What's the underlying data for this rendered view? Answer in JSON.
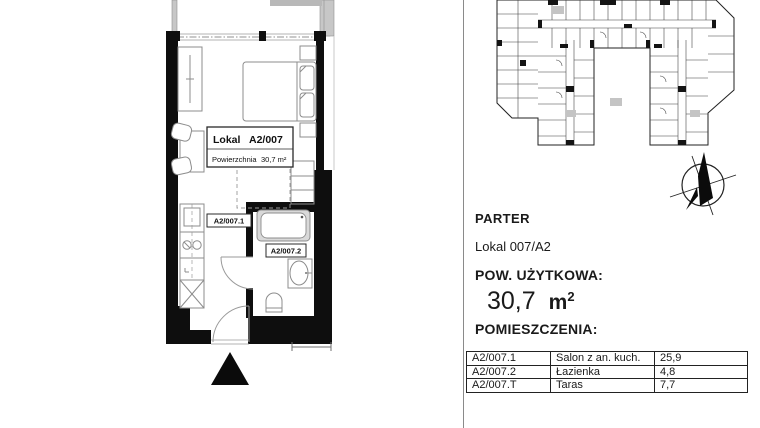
{
  "plan": {
    "label_box": {
      "title_left": "Lokal",
      "title_right": "A2/007",
      "area_label": "Powierzchnia",
      "area_value": "30,7 m²"
    },
    "room_tags": {
      "living": "A2/007.1",
      "bathroom": "A2/007.2"
    },
    "icons": {
      "compass": "compass-rose-north-arrow",
      "entrance": "entrance-triangle-marker"
    },
    "colors": {
      "wall": "#0e0e0e",
      "terrace_wall": "#c7c7c7",
      "furniture_line": "#8c8c8c"
    }
  },
  "info_panel": {
    "floor_label": "PARTER",
    "unit_label": "Lokal 007/A2",
    "area_heading": "POW. UŻYTKOWA:",
    "area_value": "30,7",
    "area_unit_base": "m",
    "area_unit_sup": "2",
    "rooms_heading": "POMIESZCZENIA:",
    "rooms_table": {
      "rows": [
        {
          "id": "A2/007.1",
          "name": "Salon z an. kuch.",
          "area": "25,9"
        },
        {
          "id": "A2/007.2",
          "name": "Łazienka",
          "area": "4,8"
        },
        {
          "id": "A2/007.T",
          "name": "Taras",
          "area": "7,7"
        }
      ]
    }
  }
}
